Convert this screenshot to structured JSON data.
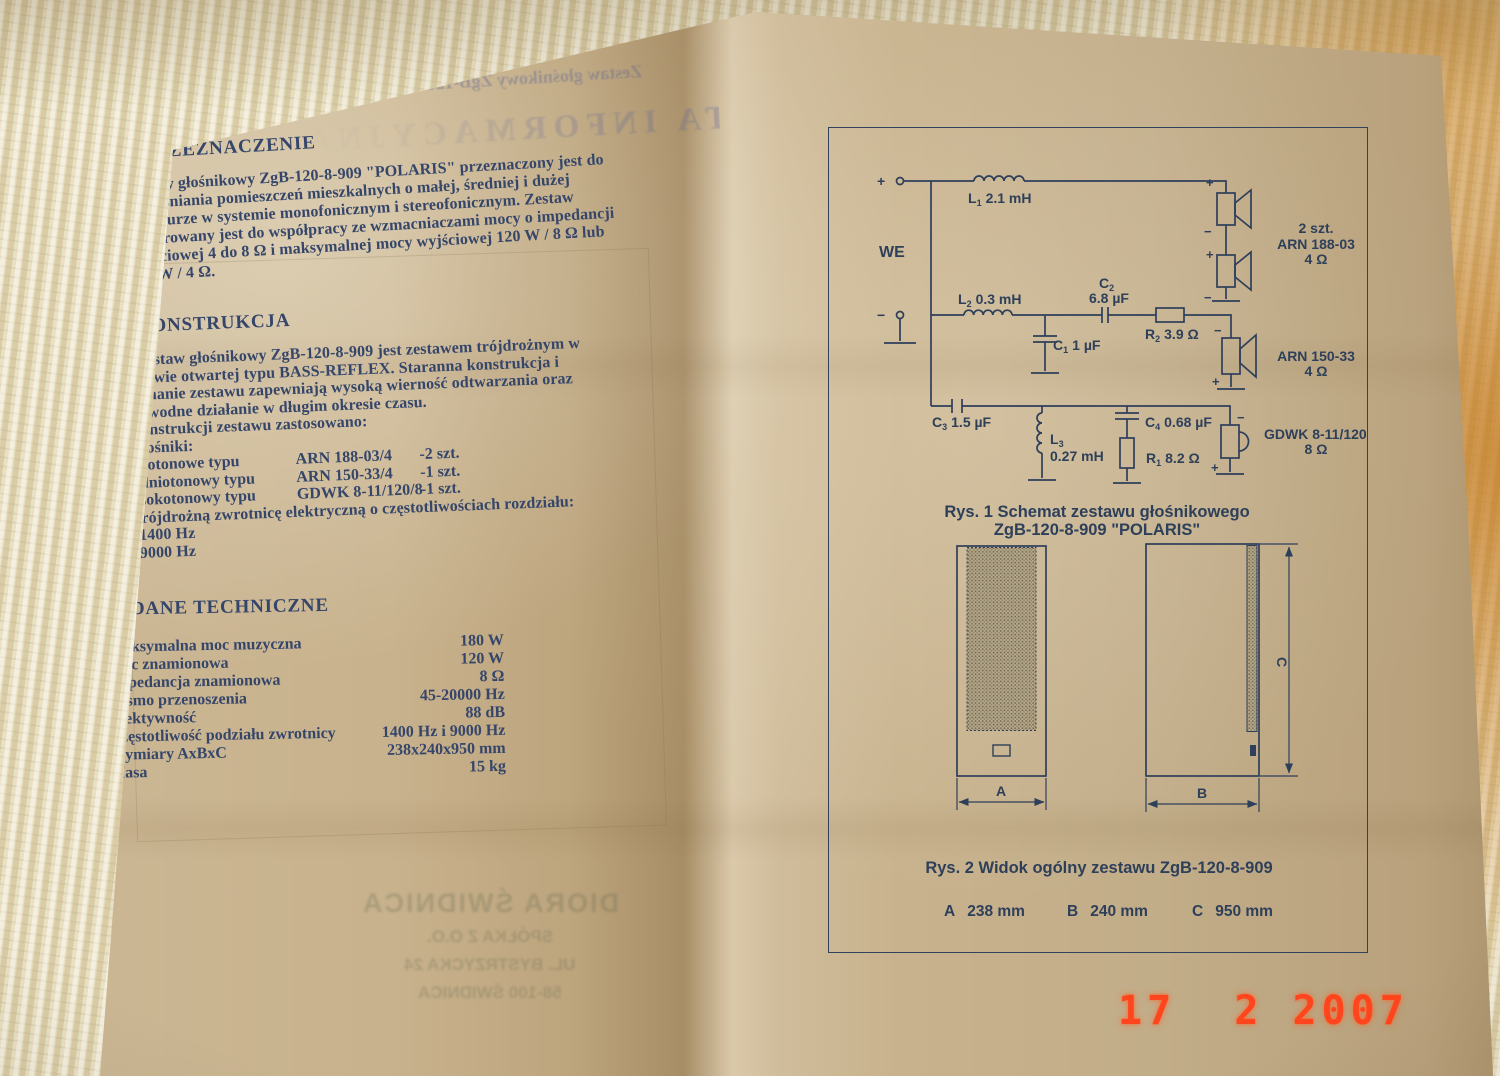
{
  "photo": {
    "date_stamp": "17  2 2007"
  },
  "ghost": {
    "header_product": "Zestaw głośnikowy ZgB-120-8-909 \"POLARIS\"",
    "header_title": "KARTA INFORMACYJNA",
    "footer_company": "DIORA ŚWIDNICA",
    "footer_line2": "SPÓŁKA Z O.O.",
    "footer_line3": "UL. BYSTRZYCKA 24",
    "footer_line4": "58-100 ŚWIDNICA"
  },
  "sections": {
    "s1": {
      "heading": "I. PRZEZNACZENIE",
      "lines": [
        "Zestaw głośnikowy ZgB-120-8-909 \"POLARIS\" przeznaczony jest do",
        "nagłaśniania pomieszczeń mieszkalnych o małej, średniej  i dużej",
        "kubaturze w systemie monofonicznym i stereofonicznym. Zestaw",
        "preferowany jest do współpracy ze wzmacniaczami mocy o impedancji",
        "wyjściowej 4 do 8 Ω i maksymalnej mocy wyjściowej  120 W / 8 Ω lub",
        "180 W / 4 Ω."
      ]
    },
    "s2": {
      "heading": "II. KONSTRUKCJA",
      "lines": [
        "Zestaw głośnikowy ZgB-120-8-909 jest zestawem trójdrożnym w",
        "obudowie otwartej typu BASS-REFLEX. Staranna konstrukcja i",
        "wykonanie zestawu zapewniają wysoką wierność odtwarzania oraz",
        "niezawodne działanie w długim okresie czasu."
      ],
      "intro": "W konstrukcji zestawu zastosowano:",
      "item1": "1. Głośniki:",
      "speakers": [
        {
          "type": "-niskotonowe typu",
          "model": "ARN 188-03/4",
          "qty": "-2 szt."
        },
        {
          "type": "-średniotonowy typu",
          "model": "ARN 150-33/4",
          "qty": "-1 szt."
        },
        {
          "type": "-wysokotonowy typu",
          "model": "GDWK 8-11/120/8",
          "qty": "-1 szt."
        }
      ],
      "item2": "2. Trójdrożną zwrotnicę elektryczną o częstotliwościach rozdziału:",
      "f1": "f1=1400 Hz",
      "f2": "f2=9000 Hz"
    },
    "s3": {
      "heading": "III. DANE TECHNICZNE",
      "specs": [
        {
          "label": "Maksymalna moc muzyczna",
          "value": "180 W"
        },
        {
          "label": "Moc znamionowa",
          "value": "120 W"
        },
        {
          "label": "Impedancja znamionowa",
          "value": "8 Ω"
        },
        {
          "label": "Pasmo przenoszenia",
          "value": "45-20000 Hz"
        },
        {
          "label": "Efektywność",
          "value": "88 dB"
        },
        {
          "label": "Częstotliwość podziału zwrotnicy",
          "value": "1400 Hz i 9000 Hz"
        },
        {
          "label": "Wymiary AxBxC",
          "value": "238x240x950 mm"
        },
        {
          "label": "Masa",
          "value": "15 kg"
        }
      ]
    }
  },
  "schematic": {
    "we": "WE",
    "plus": "+",
    "minus": "−",
    "l1": {
      "ref": "L",
      "sub": "1",
      "val": "2.1 mH"
    },
    "l2": {
      "ref": "L",
      "sub": "2",
      "val": "0.3 mH"
    },
    "l3": {
      "ref": "L",
      "sub": "3",
      "val": "0.27 mH"
    },
    "c1": {
      "ref": "C",
      "sub": "1",
      "val": "1 µF"
    },
    "c2": {
      "ref": "C",
      "sub": "2",
      "val": "6.8 µF"
    },
    "c3": {
      "ref": "C",
      "sub": "3",
      "val": "1.5 µF"
    },
    "c4": {
      "ref": "C",
      "sub": "4",
      "val": "0.68 µF"
    },
    "r1": {
      "ref": "R",
      "sub": "1",
      "val": "8.2 Ω"
    },
    "r2": {
      "ref": "R",
      "sub": "2",
      "val": "3.9 Ω"
    },
    "woofer": {
      "qty": "2 szt.",
      "model": "ARN 188-03",
      "impedance": "4 Ω"
    },
    "midrange": {
      "model": "ARN 150-33",
      "impedance": "4 Ω"
    },
    "tweeter": {
      "model": "GDWK 8-11/120",
      "impedance": "8 Ω"
    },
    "caption1": "Rys. 1 Schemat zestawu głośnikowego",
    "caption2": "ZgB-120-8-909 \"POLARIS\""
  },
  "figure2": {
    "caption": "Rys. 2 Widok ogólny zestawu ZgB-120-8-909",
    "dim_a": "A",
    "dim_b": "B",
    "dim_c": "C",
    "dims": [
      {
        "label": "A",
        "value": "238 mm"
      },
      {
        "label": "B",
        "value": "240 mm"
      },
      {
        "label": "C",
        "value": "950 mm"
      }
    ]
  }
}
